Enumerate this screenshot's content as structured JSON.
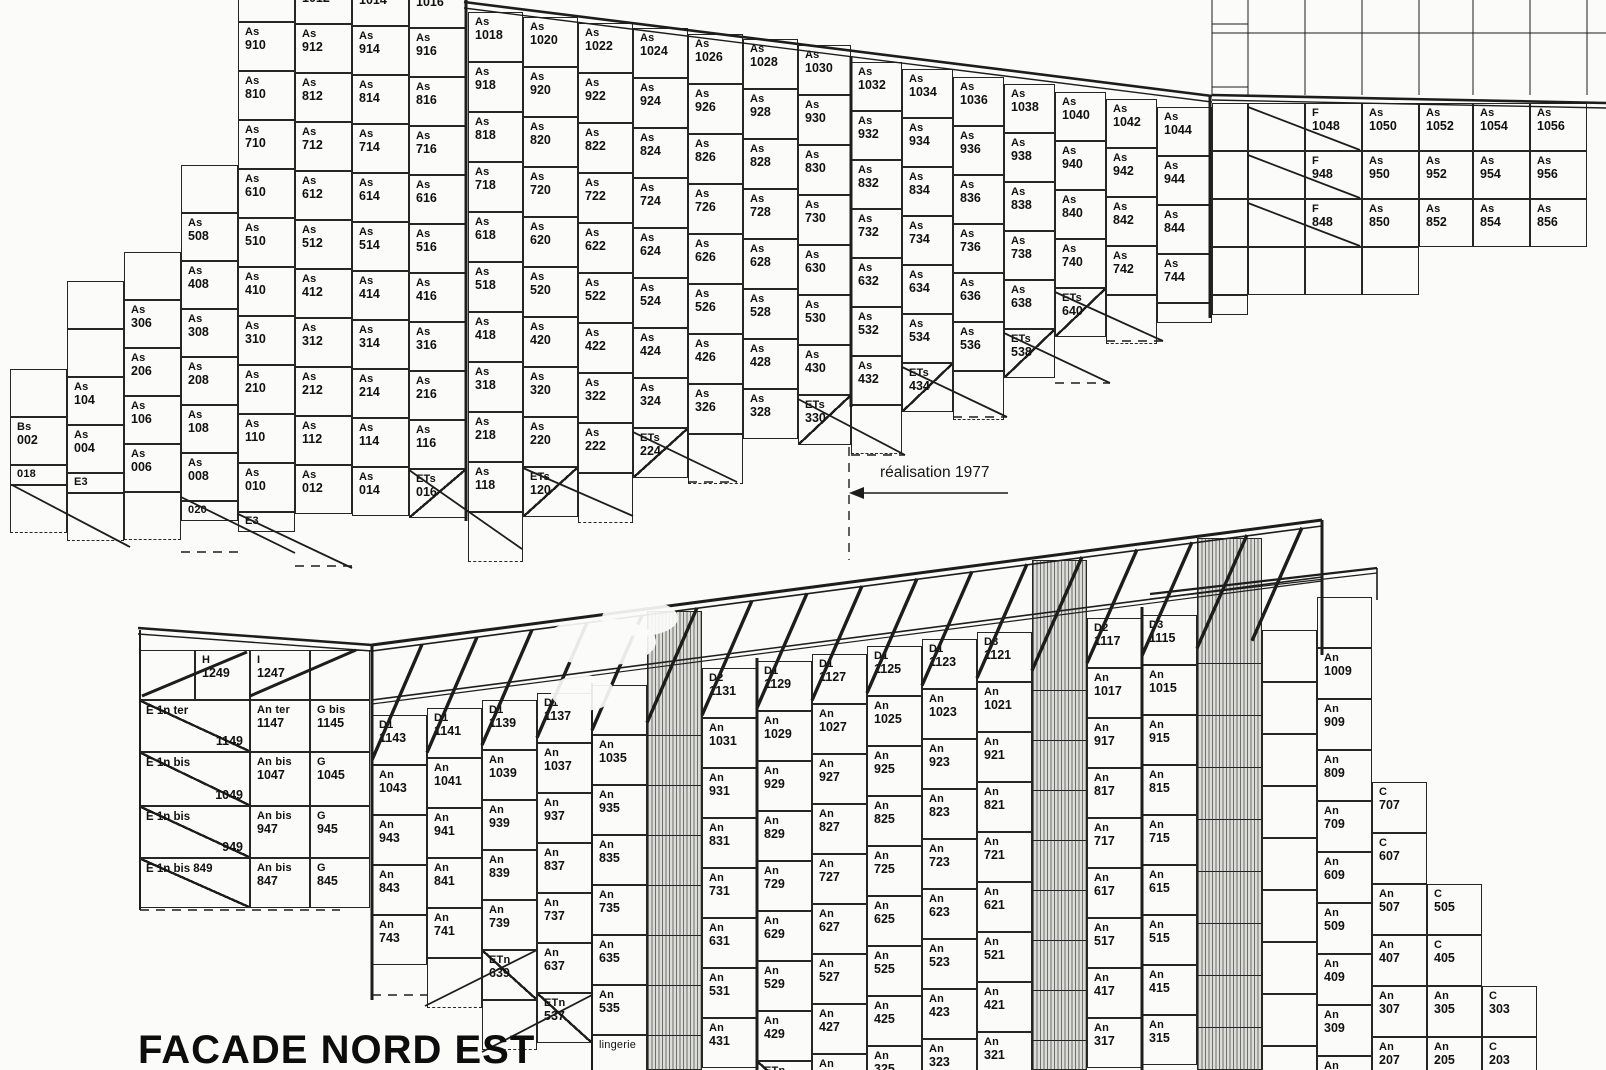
{
  "labels": {
    "facade": "FACADE NORD EST",
    "annotation": "réalisation 1977"
  },
  "top_building": {
    "columns": [
      {
        "x": 10,
        "w": 57,
        "t": 369,
        "ch": 48,
        "cells": [
          "",
          "Bs 002",
          "_018",
          "^-"
        ]
      },
      {
        "x": 67,
        "w": 57,
        "t": 281,
        "ch": 48,
        "cells": [
          "",
          "",
          "As 104",
          "As 004",
          "_E3",
          "^-"
        ]
      },
      {
        "x": 124,
        "w": 57,
        "t": 252,
        "ch": 48,
        "cells": [
          "",
          "As 306",
          "As 206",
          "As 106",
          "As 006",
          "^-"
        ]
      },
      {
        "x": 181,
        "w": 57,
        "t": 165,
        "ch": 48,
        "cells": [
          "",
          "As 508",
          "As 408",
          "As 308",
          "As 208",
          "As 108",
          "As 008",
          "_020"
        ]
      },
      {
        "x": 238,
        "w": 57,
        "t": -27,
        "ch": 49,
        "cells": [
          "As 1010",
          "As 910",
          "As 810",
          "As 710",
          "As 610",
          "As 510",
          "As 410",
          "As 310",
          "As 210",
          "As 110",
          "As 010",
          "_E3"
        ]
      },
      {
        "x": 295,
        "w": 57,
        "t": -25,
        "ch": 49,
        "cells": [
          "As 1012",
          "As 912",
          "As 812",
          "As 712",
          "As 612",
          "As 512",
          "As 412",
          "As 312",
          "As 212",
          "As 112",
          "As 012"
        ]
      },
      {
        "x": 352,
        "w": 57,
        "t": -23,
        "ch": 49,
        "cells": [
          "As 1014",
          "As 914",
          "As 814",
          "As 714",
          "As 614",
          "As 514",
          "As 414",
          "As 314",
          "As 214",
          "As 114",
          "As 014"
        ]
      },
      {
        "x": 409,
        "w": 57,
        "t": -21,
        "ch": 49,
        "cells": [
          "As 1016",
          "As 916",
          "As 816",
          "As 716",
          "As 616",
          "As 516",
          "As 416",
          "As 316",
          "As 216",
          "As 116",
          "\\ETs 016"
        ]
      },
      {
        "x": 468,
        "w": 55,
        "t": 12,
        "ch": 50,
        "cells": [
          "As 1018",
          "As 918",
          "As 818",
          "As 718",
          "As 618",
          "As 518",
          "As 418",
          "As 318",
          "As 218",
          "As 118",
          "^-"
        ]
      },
      {
        "x": 523,
        "w": 55,
        "t": 17,
        "ch": 50,
        "cells": [
          "As 1020",
          "As 920",
          "As 820",
          "As 720",
          "As 620",
          "As 520",
          "As 420",
          "As 320",
          "As 220",
          "\\ETs 120"
        ]
      },
      {
        "x": 578,
        "w": 55,
        "t": 23,
        "ch": 50,
        "cells": [
          "As 1022",
          "As 922",
          "As 822",
          "As 722",
          "As 622",
          "As 522",
          "As 422",
          "As 322",
          "As 222",
          "^-"
        ]
      },
      {
        "x": 633,
        "w": 55,
        "t": 28,
        "ch": 50,
        "cells": [
          "As 1024",
          "As 924",
          "As 824",
          "As 724",
          "As 624",
          "As 524",
          "As 424",
          "As 324",
          "\\ETs 224"
        ]
      },
      {
        "x": 688,
        "w": 55,
        "t": 34,
        "ch": 50,
        "cells": [
          "As 1026",
          "As 926",
          "As 826",
          "As 726",
          "As 626",
          "As 526",
          "As 426",
          "As 326",
          "^-"
        ]
      },
      {
        "x": 743,
        "w": 55,
        "t": 39,
        "ch": 50,
        "cells": [
          "As 1028",
          "As 928",
          "As 828",
          "As 728",
          "As 628",
          "As 528",
          "As 428",
          "As 328"
        ]
      },
      {
        "x": 798,
        "w": 53,
        "t": 45,
        "ch": 50,
        "cells": [
          "As 1030",
          "As 930",
          "As 830",
          "As 730",
          "As 630",
          "As 530",
          "As 430",
          "\\ETs 330"
        ]
      },
      {
        "x": 851,
        "w": 51,
        "t": 62,
        "ch": 49,
        "cells": [
          "As 1032",
          "As 932",
          "As 832",
          "As 732",
          "As 632",
          "As 532",
          "As 432",
          "^-"
        ]
      },
      {
        "x": 902,
        "w": 51,
        "t": 69,
        "ch": 49,
        "cells": [
          "As 1034",
          "As 934",
          "As 834",
          "As 734",
          "As 634",
          "As 534",
          "\\ETs 434"
        ]
      },
      {
        "x": 953,
        "w": 51,
        "t": 77,
        "ch": 49,
        "cells": [
          "As 1036",
          "As 936",
          "As 836",
          "As 736",
          "As 636",
          "As 536",
          "^-"
        ]
      },
      {
        "x": 1004,
        "w": 51,
        "t": 84,
        "ch": 49,
        "cells": [
          "As 1038",
          "As 938",
          "As 838",
          "As 738",
          "As 638",
          "\\ETs 538"
        ]
      },
      {
        "x": 1055,
        "w": 51,
        "t": 92,
        "ch": 49,
        "cells": [
          "As 1040",
          "As 940",
          "As 840",
          "As 740",
          "\\ETs 640"
        ]
      },
      {
        "x": 1106,
        "w": 51,
        "t": 99,
        "ch": 49,
        "cells": [
          "As 1042",
          "As 942",
          "As 842",
          "As 742",
          "^-"
        ]
      },
      {
        "x": 1157,
        "w": 55,
        "t": 107,
        "ch": 49,
        "cells": [
          "As 1044",
          "As 944",
          "As 844",
          "As 744",
          "_"
        ]
      },
      {
        "x": 1212,
        "w": 36,
        "t": 103,
        "ch": 48,
        "cells": [
          "",
          "",
          "",
          "",
          "_"
        ]
      }
    ],
    "f_rows": [
      {
        "y": 103,
        "h": 48,
        "cells": [
          {
            "x": 1248,
            "w": 57,
            "t": ""
          },
          {
            "x": 1305,
            "w": 57,
            "t": "F 1048"
          },
          {
            "x": 1362,
            "w": 57,
            "t": "As 1050"
          },
          {
            "x": 1419,
            "w": 54,
            "t": "As 1052"
          },
          {
            "x": 1473,
            "w": 57,
            "t": "As 1054"
          },
          {
            "x": 1530,
            "w": 57,
            "t": "As 1056"
          }
        ]
      },
      {
        "y": 151,
        "h": 48,
        "cells": [
          {
            "x": 1248,
            "w": 57,
            "t": ""
          },
          {
            "x": 1305,
            "w": 57,
            "t": "F 948"
          },
          {
            "x": 1362,
            "w": 57,
            "t": "As 950"
          },
          {
            "x": 1419,
            "w": 54,
            "t": "As 952"
          },
          {
            "x": 1473,
            "w": 57,
            "t": "As 954"
          },
          {
            "x": 1530,
            "w": 57,
            "t": "As 956"
          }
        ]
      },
      {
        "y": 199,
        "h": 48,
        "cells": [
          {
            "x": 1248,
            "w": 57,
            "t": ""
          },
          {
            "x": 1305,
            "w": 57,
            "t": "F 848"
          },
          {
            "x": 1362,
            "w": 57,
            "t": "As 850"
          },
          {
            "x": 1419,
            "w": 54,
            "t": "As 852"
          },
          {
            "x": 1473,
            "w": 57,
            "t": "As 854"
          },
          {
            "x": 1530,
            "w": 57,
            "t": "As 856"
          }
        ]
      },
      {
        "y": 247,
        "h": 48,
        "cells": [
          {
            "x": 1248,
            "w": 57,
            "t": ""
          },
          {
            "x": 1305,
            "w": 57,
            "t": ""
          },
          {
            "x": 1362,
            "w": 57,
            "t": ""
          }
        ]
      }
    ]
  },
  "bottom_building": {
    "left_rows": [
      {
        "y": 650,
        "h": 50,
        "cells": [
          {
            "x": 140,
            "w": 55,
            "t": ""
          },
          {
            "x": 195,
            "w": 55,
            "t": "H 1249"
          },
          {
            "x": 250,
            "w": 60,
            "t": "I 1247"
          },
          {
            "x": 310,
            "w": 60,
            "t": ""
          }
        ]
      },
      {
        "y": 700,
        "h": 52,
        "cells": [
          {
            "x": 140,
            "w": 110,
            "t": "/E 1n ter|1149",
            "e": 1
          },
          {
            "x": 250,
            "w": 60,
            "t": "An ter 1147"
          },
          {
            "x": 310,
            "w": 60,
            "t": "G bis 1145"
          }
        ]
      },
      {
        "y": 752,
        "h": 54,
        "cells": [
          {
            "x": 140,
            "w": 110,
            "t": "/E 1n bis|1049",
            "e": 1
          },
          {
            "x": 250,
            "w": 60,
            "t": "An bis 1047"
          },
          {
            "x": 310,
            "w": 60,
            "t": "G 1045"
          }
        ]
      },
      {
        "y": 806,
        "h": 52,
        "cells": [
          {
            "x": 140,
            "w": 110,
            "t": "/E 1n bis|949",
            "e": 1
          },
          {
            "x": 250,
            "w": 60,
            "t": "An bis 947"
          },
          {
            "x": 310,
            "w": 60,
            "t": "G 945"
          }
        ]
      },
      {
        "y": 858,
        "h": 50,
        "cells": [
          {
            "x": 140,
            "w": 110,
            "t": "/E 1n bis 849|",
            "e": 1
          },
          {
            "x": 250,
            "w": 60,
            "t": "An bis 847"
          },
          {
            "x": 310,
            "w": 60,
            "t": "G 845"
          }
        ]
      }
    ],
    "columns": [
      {
        "x": 372,
        "w": 55,
        "t": 715,
        "ch": 50,
        "cells": [
          "D1 1143",
          "An 1043",
          "An 943",
          "An 843",
          "An 743"
        ]
      },
      {
        "x": 427,
        "w": 55,
        "t": 708,
        "ch": 50,
        "cells": [
          "D1 1141",
          "An 1041",
          "An 941",
          "An 841",
          "An 741",
          "^-"
        ]
      },
      {
        "x": 482,
        "w": 55,
        "t": 700,
        "ch": 50,
        "cells": [
          "D1 1139",
          "An 1039",
          "An 939",
          "An 839",
          "An 739",
          "/ETn 639",
          "^-"
        ]
      },
      {
        "x": 537,
        "w": 55,
        "t": 693,
        "ch": 50,
        "cells": [
          "D1 1137",
          "An 1037",
          "An 937",
          "An 837",
          "An 737",
          "An 637",
          "/ETn 537"
        ]
      },
      {
        "x": 592,
        "w": 55,
        "t": 685,
        "ch": 50,
        "cells": [
          "",
          "An 1035",
          "An 935",
          "An 835",
          "An 735",
          "An 635",
          "An 535",
          "~lingerie"
        ]
      },
      {
        "x": 702,
        "w": 55,
        "t": 668,
        "ch": 50,
        "cells": [
          "D2 1131",
          "An 1031",
          "An 931",
          "An 831",
          "An 731",
          "An 631",
          "An 531",
          "An 431"
        ]
      },
      {
        "x": 757,
        "w": 55,
        "t": 661,
        "ch": 50,
        "cells": [
          "D1 1129",
          "An 1029",
          "An 929",
          "An 829",
          "An 729",
          "An 629",
          "An 529",
          "An 429",
          "/ETn 329"
        ]
      },
      {
        "x": 812,
        "w": 55,
        "t": 654,
        "ch": 50,
        "cells": [
          "D1 1127",
          "An 1027",
          "An 927",
          "An 827",
          "An 727",
          "An 627",
          "An 527",
          "An 427",
          "An 327"
        ]
      },
      {
        "x": 867,
        "w": 55,
        "t": 646,
        "ch": 50,
        "cells": [
          "D1 1125",
          "An 1025",
          "An 925",
          "An 825",
          "An 725",
          "An 625",
          "An 525",
          "An 425",
          "An 325"
        ]
      },
      {
        "x": 922,
        "w": 55,
        "t": 639,
        "ch": 50,
        "cells": [
          "D1 1123",
          "An 1023",
          "An 923",
          "An 823",
          "An 723",
          "An 623",
          "An 523",
          "An 423",
          "An 323"
        ]
      },
      {
        "x": 977,
        "w": 55,
        "t": 632,
        "ch": 50,
        "cells": [
          "D3 1121",
          "An 1021",
          "An 921",
          "An 821",
          "An 721",
          "An 621",
          "An 521",
          "An 421",
          "An 321"
        ]
      },
      {
        "x": 1087,
        "w": 55,
        "t": 618,
        "ch": 50,
        "cells": [
          "D2 1117",
          "An 1017",
          "An 917",
          "An 817",
          "An 717",
          "An 617",
          "An 517",
          "An 417",
          "An 317"
        ]
      },
      {
        "x": 1142,
        "w": 55,
        "t": 615,
        "ch": 50,
        "cells": [
          "D3 1115",
          "An 1015",
          "An 915",
          "An 815",
          "An 715",
          "An 615",
          "An 515",
          "An 415",
          "An 315"
        ]
      },
      {
        "x": 1262,
        "w": 55,
        "t": 630,
        "ch": 52,
        "cells": [
          "",
          "",
          "",
          "",
          "",
          "",
          "",
          "",
          ""
        ]
      },
      {
        "x": 1317,
        "w": 55,
        "t": 597,
        "ch": 51,
        "cells": [
          "",
          "An 1009",
          "An 909",
          "An 809",
          "An 709",
          "An 609",
          "An 509",
          "An 409",
          "An 309",
          "An 209"
        ]
      },
      {
        "x": 1372,
        "w": 55,
        "t": 782,
        "ch": 51,
        "cells": [
          "C 707",
          "C 607",
          "An 507",
          "An 407",
          "An 307",
          "An 207"
        ]
      },
      {
        "x": 1427,
        "w": 55,
        "t": 884,
        "ch": 51,
        "cells": [
          "C 505",
          "C 405",
          "An 305",
          "An 205"
        ]
      },
      {
        "x": 1482,
        "w": 55,
        "t": 986,
        "ch": 51,
        "cells": [
          "C 303",
          "C 203"
        ]
      }
    ],
    "hatched": [
      {
        "x": 647,
        "w": 55,
        "t": 611,
        "b": 1070,
        "lines": [
          735,
          785,
          835,
          885,
          935,
          985,
          1035
        ]
      },
      {
        "x": 1032,
        "w": 55,
        "t": 560,
        "b": 1070,
        "lines": [
          690,
          740,
          790,
          840,
          890,
          940,
          990,
          1040
        ]
      },
      {
        "x": 1197,
        "w": 65,
        "t": 538,
        "b": 1070,
        "lines": [
          663,
          715,
          767,
          819,
          871,
          923,
          975,
          1027
        ]
      }
    ]
  }
}
